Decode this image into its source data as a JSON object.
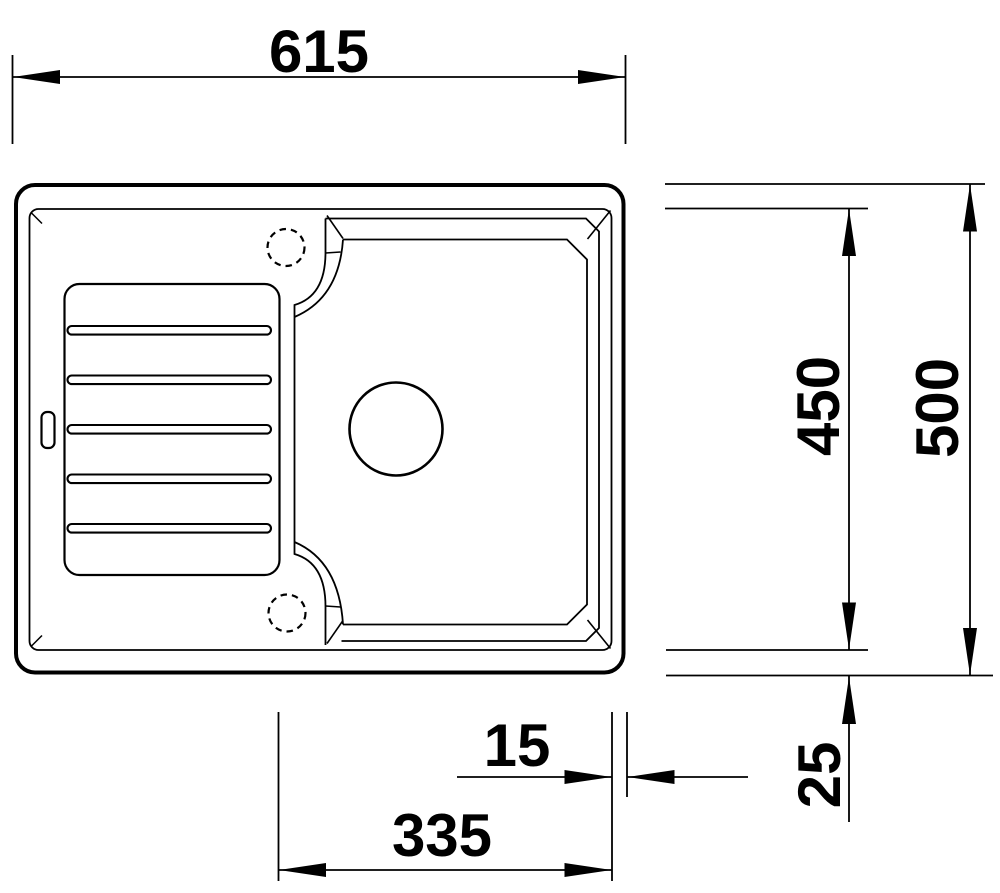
{
  "drawing": {
    "title": "sink-top-view-dimension-drawing",
    "background_color": "#ffffff",
    "line_color": "#000000",
    "units": "mm",
    "dimensions": {
      "overall_width": {
        "value": "615",
        "orientation": "horizontal",
        "position": "top"
      },
      "overall_depth": {
        "value": "500",
        "orientation": "vertical",
        "position": "right-outer"
      },
      "inner_depth": {
        "value": "450",
        "orientation": "vertical",
        "position": "right-inner"
      },
      "bowl_width": {
        "value": "335",
        "orientation": "horizontal",
        "position": "bottom"
      },
      "rim_width": {
        "value": "15",
        "orientation": "horizontal",
        "position": "bottom-right"
      },
      "edge_offset": {
        "value": "25",
        "orientation": "vertical",
        "position": "bottom-right"
      }
    },
    "features": {
      "drainboard_ribs": 5,
      "tap_holes": 2,
      "bowls": 1
    }
  }
}
